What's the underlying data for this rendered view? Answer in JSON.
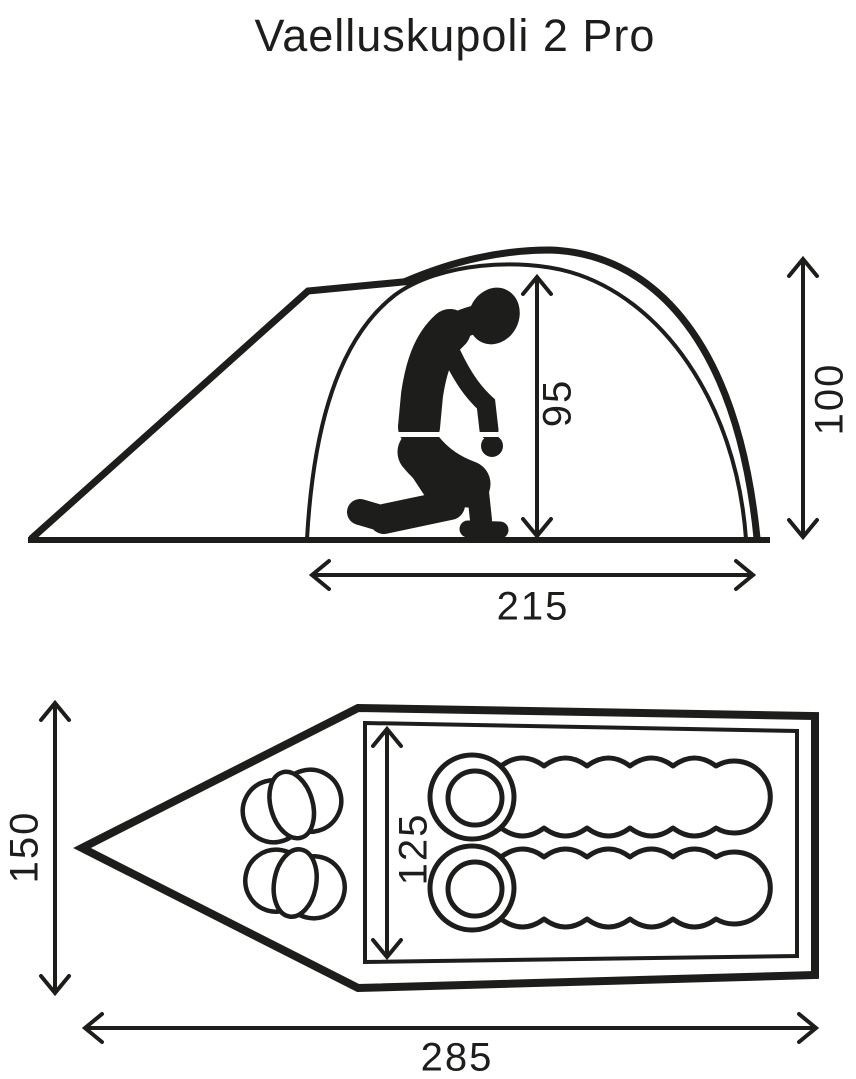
{
  "title": "Vaelluskupoli 2 Pro",
  "colors": {
    "line": "#1d1d1b",
    "background": "#ffffff"
  },
  "side_view": {
    "inner_height": "95",
    "outer_height": "100",
    "inner_length": "215"
  },
  "floor_plan": {
    "outer_width": "150",
    "inner_width": "125",
    "total_length": "285"
  }
}
